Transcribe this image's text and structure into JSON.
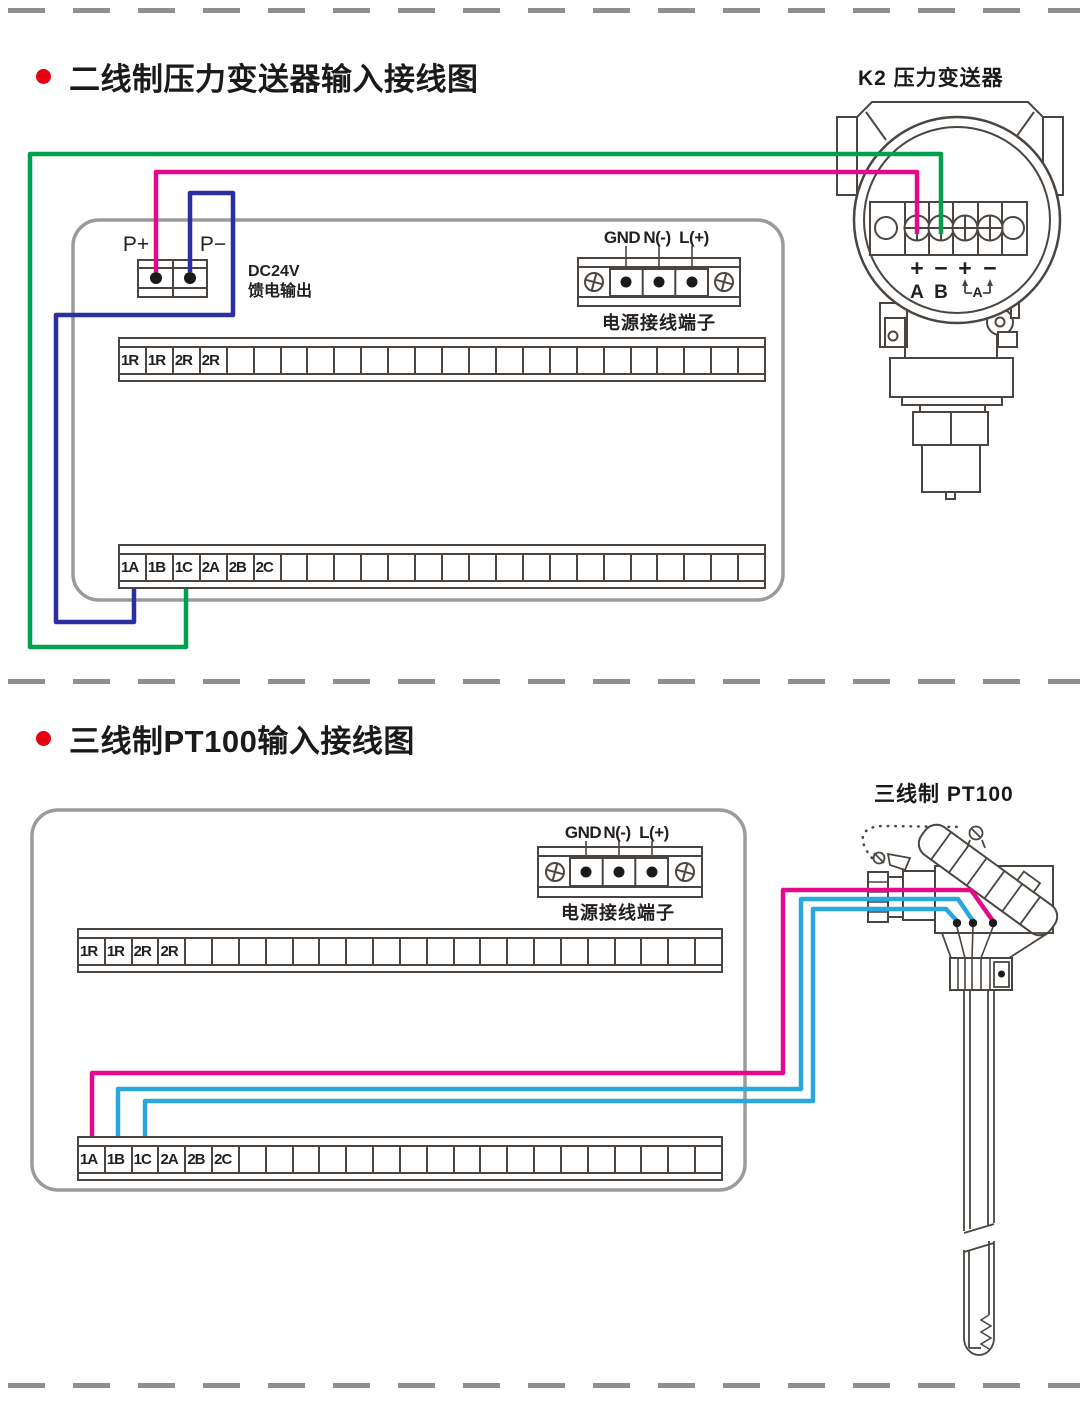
{
  "colors": {
    "green": "#00a04e",
    "pink": "#e6088a",
    "navy": "#2b2fa2",
    "cyan": "#2ba7e0",
    "bullet_red": "#e60012",
    "box_gray": "#9b9b9b",
    "line_dark": "#4a4540",
    "dash_gray": "#8f8f8f"
  },
  "section1": {
    "title": "二线制压力变送器输入接线图",
    "device_label": "K2  压力变送器",
    "feed": {
      "p_plus": "P+",
      "p_minus": "P−",
      "dc_line1": "DC24V",
      "dc_line2": "馈电输出"
    },
    "power": {
      "gnd": "GND",
      "n": "N(-)",
      "l": "L(+)",
      "caption": "电源接线端子"
    },
    "device": {
      "signs": [
        "+",
        "−",
        "+",
        "−"
      ],
      "terminals": [
        "A",
        "B"
      ],
      "loop": "A"
    },
    "strip_top_cells": [
      "1R",
      "1R",
      "2R",
      "2R",
      "",
      "",
      "",
      "",
      "",
      "",
      "",
      "",
      "",
      "",
      "",
      "",
      "",
      "",
      "",
      "",
      "",
      "",
      "",
      ""
    ],
    "strip_bottom_cells": [
      "1A",
      "1B",
      "1C",
      "2A",
      "2B",
      "2C",
      "",
      "",
      "",
      "",
      "",
      "",
      "",
      "",
      "",
      "",
      "",
      "",
      "",
      "",
      "",
      "",
      "",
      ""
    ]
  },
  "section2": {
    "title": "三线制PT100输入接线图",
    "device_label": "三线制  PT100",
    "power": {
      "gnd": "GND",
      "n": "N(-)",
      "l": "L(+)",
      "caption": "电源接线端子"
    },
    "strip_top_cells": [
      "1R",
      "1R",
      "2R",
      "2R",
      "",
      "",
      "",
      "",
      "",
      "",
      "",
      "",
      "",
      "",
      "",
      "",
      "",
      "",
      "",
      "",
      "",
      "",
      "",
      ""
    ],
    "strip_bottom_cells": [
      "1A",
      "1B",
      "1C",
      "2A",
      "2B",
      "2C",
      "",
      "",
      "",
      "",
      "",
      "",
      "",
      "",
      "",
      "",
      "",
      "",
      "",
      "",
      "",
      "",
      "",
      ""
    ]
  }
}
